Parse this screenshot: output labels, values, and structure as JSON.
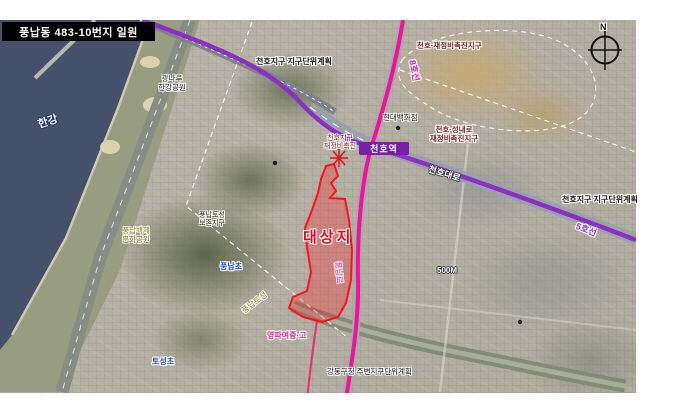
{
  "title_box": {
    "text": "풍납동 483-10번지 일원"
  },
  "compass": {
    "north": "N"
  },
  "site": {
    "label": "대상지",
    "outline_color": "#ff1020"
  },
  "transit": {
    "line5": {
      "label": "5호선",
      "color": "#8c2fc4"
    },
    "line8": {
      "label": "8호선",
      "color": "#f2119b"
    },
    "station_cheonho": "천호역"
  },
  "roads": {
    "cheonho_daero": "천호대로",
    "pungnap_ro": "풍납로"
  },
  "labels": {
    "hangang": "한강",
    "gwangnaru_1": "광나루",
    "gwangnaru_2": "한강공원",
    "cheonho_plan_top": "천호지구 지구단위계획",
    "cheonho_plan_right": "천호지구 지구단위계획",
    "cheonho_promo": "천호·재정비촉진지구",
    "cheonho_seongnae_1": "천호·성내로",
    "cheonho_seongnae_2": "재정비촉진지구",
    "cheonho_zone_1": "천호지구",
    "cheonho_zone_2": "재정비촉진",
    "hyundai_dept": "현대백화점",
    "toseong_zone_1": "풍납토성",
    "toseong_zone_2": "보존지구",
    "baekje_park_1": "풍납백제",
    "baekje_park_2": "문화공원",
    "pungnap_elem": "풍납초",
    "toseong_diag": "풍납토성",
    "yeongpa": "영파여중·고",
    "toseong_elem": "토성초",
    "gangdong_plan": "강동구청 주변지구단위계획",
    "scale_500m": "500M"
  }
}
